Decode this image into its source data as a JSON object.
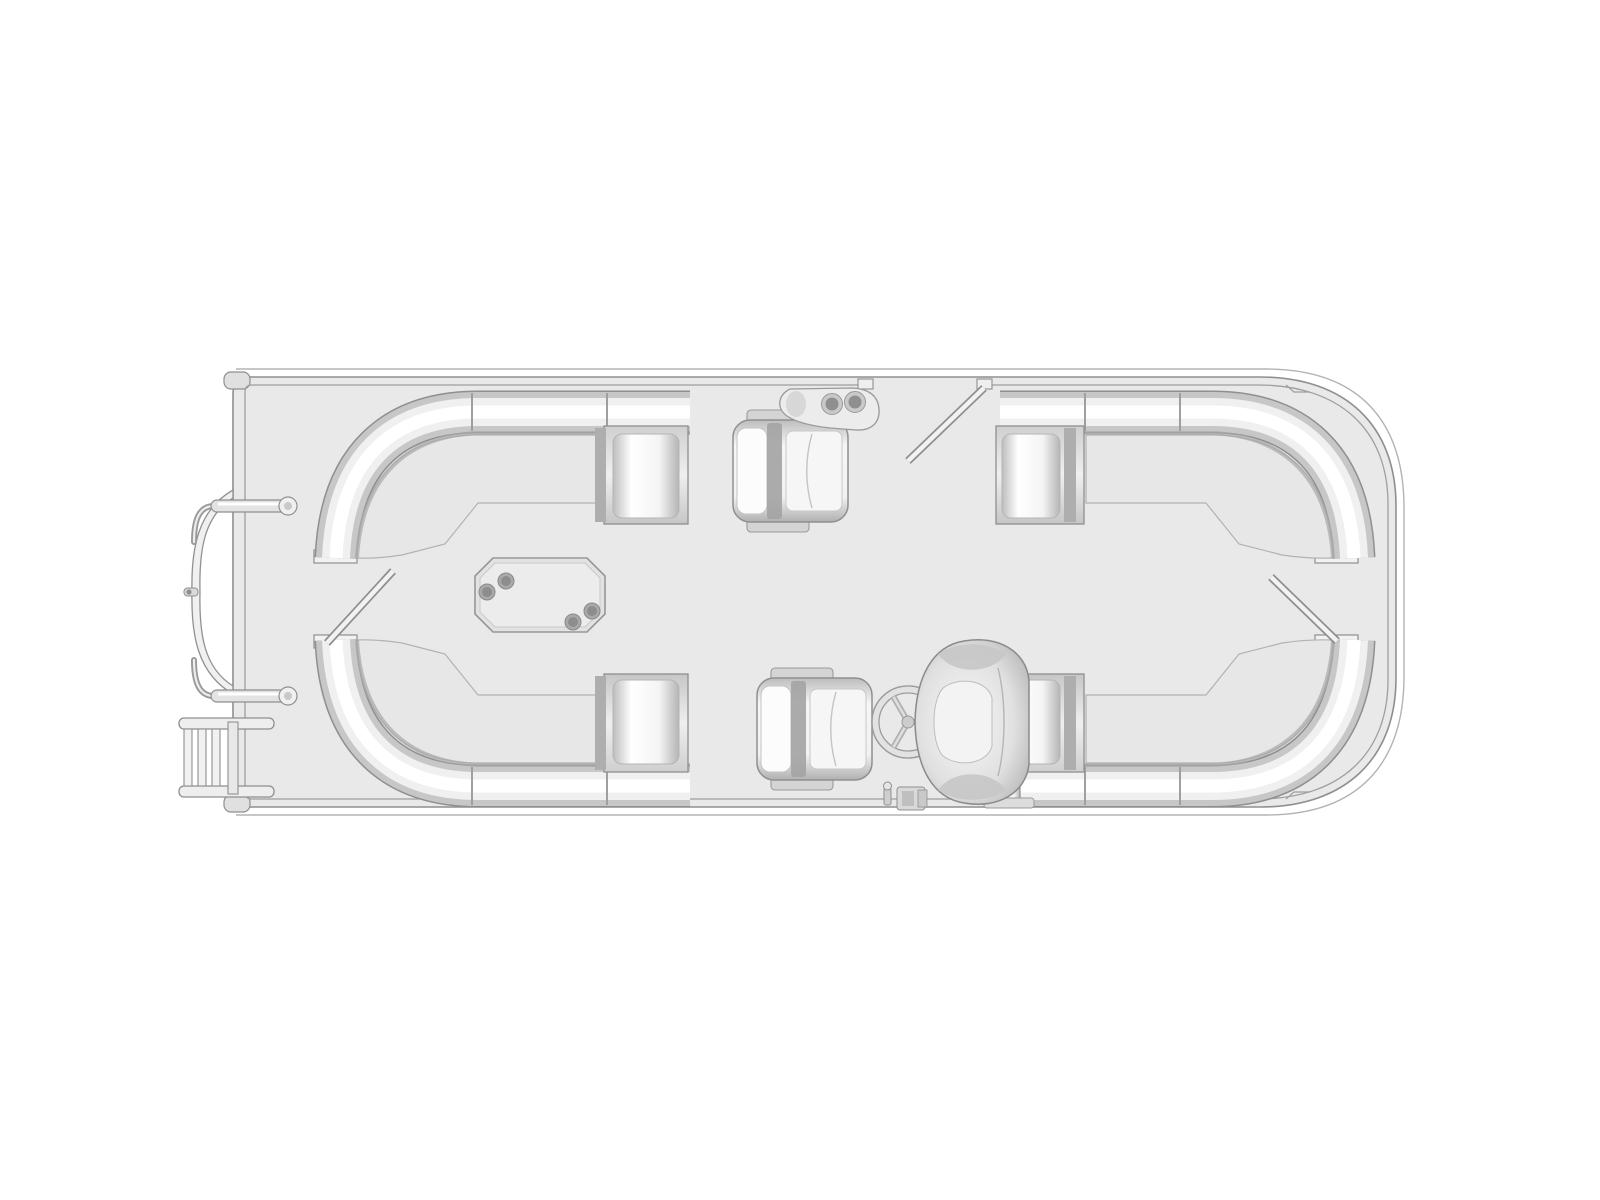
{
  "page": {
    "background": "#ffffff"
  },
  "diagram": {
    "type": "boat-floor-plan",
    "subject": "pontoon boat deck layout, overhead plan view, bow at left / stern at right",
    "colors": {
      "background": "#ffffff",
      "deck": "#e9e9e9",
      "hull_outline": "#8f8f8f",
      "rub_rail": "#b3b3b3",
      "fence_line": "#9f9f9f",
      "tube_shade": "#c7c7c7",
      "tube_highlight": "#ffffff",
      "seat_fill": "#e7e7e7",
      "seat_line": "#b2b2b2",
      "cushion_light": "#fcfcfc",
      "cushion_shadow": "#b5b5b5",
      "divider_dark": "#aeaeae",
      "table_top": "#e2e2e2",
      "cupholder_ring": "#a9a9a9",
      "cupholder_well": "#8d8d8d",
      "accent_dark": "#9a9a9a"
    },
    "components": {
      "bow_boarding_ladder": {
        "rails": 2,
        "rungs": 3
      },
      "bow_gate": {
        "state": "closed",
        "latch": 1
      },
      "bow_grab_handles": 2,
      "wraparound_lounges": [
        {
          "id": "bow-top-lounge"
        },
        {
          "id": "bow-bottom-lounge"
        },
        {
          "id": "stern-top-lounge"
        },
        {
          "id": "stern-bottom-lounge"
        }
      ],
      "recliner_chairs": 2,
      "cocktail_table": {
        "cupholders": 4
      },
      "rail_cupholder_console": {
        "cupholders": 2
      },
      "helm": {
        "steering_wheel": {
          "spokes": 3
        },
        "captains_chair": 1,
        "throttle_controls": 1
      },
      "side_gates_open": 3
    }
  }
}
